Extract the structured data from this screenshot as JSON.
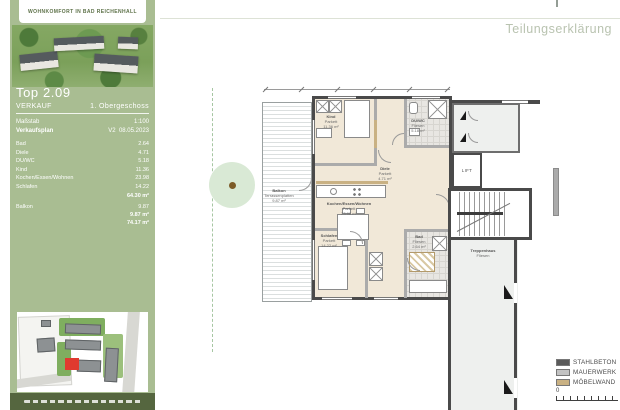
{
  "doc": {
    "label": "Teilungserklärung"
  },
  "sidebar": {
    "brand": {
      "tagline": "WOHNKOMFORT IN BAD REICHENHALL"
    },
    "unit": {
      "title": "Top 2.09",
      "status": "VERKAUF",
      "floor": "1. Obergeschoss",
      "scale_label": "Maßstab",
      "scale_value": "1:100",
      "plan_label": "Verkaufsplan",
      "plan_version": "V2",
      "plan_date": "08.05.2023"
    },
    "areas": {
      "rows": [
        {
          "label": "Bad",
          "value": "2.64"
        },
        {
          "label": "Diele",
          "value": "4.71"
        },
        {
          "label": "DU/WC",
          "value": "5.18"
        },
        {
          "label": "Kind",
          "value": "11.36"
        },
        {
          "label": "Kochen/Essen/Wohnen",
          "value": "23.98"
        },
        {
          "label": "Schlafen",
          "value": "14.22"
        }
      ],
      "subtotal": "64.30 m²",
      "balcony_row": {
        "label": "Balkon",
        "value": "9.87"
      },
      "balcony_subtotal": "9.87 m²",
      "total": "74.17 m²"
    }
  },
  "plan": {
    "rooms": [
      {
        "name": "Kind",
        "floor": "Parkett",
        "area": "11.36 m²"
      },
      {
        "name": "DU/WC",
        "floor": "Fliesen",
        "area": "5.18 m²"
      },
      {
        "name": "Diele",
        "floor": "Parkett",
        "area": "4.71 m²"
      },
      {
        "name": "Kochen/Essen/Wohnen",
        "floor": "Parkett",
        "area": "23.98 m²"
      },
      {
        "name": "Schlafen",
        "floor": "Parkett",
        "area": "14.22 m²"
      },
      {
        "name": "Bad",
        "floor": "Fliesen",
        "area": "2.64 m²"
      },
      {
        "name": "Balkon",
        "floor": "Terrassenplatten",
        "area": "9.87 m²"
      },
      {
        "name": "Treppenhaus",
        "floor": "Fliesen",
        "area": ""
      }
    ],
    "lift_label": "LIFT"
  },
  "legend": {
    "items": [
      {
        "label": "STAHLBETON",
        "color": "#5a5a5a"
      },
      {
        "label": "MAUERWERK",
        "color": "#c2c2c2"
      },
      {
        "label": "MÖBELWAND",
        "color": "#c9b183"
      }
    ],
    "scale_zero": "0"
  },
  "colors": {
    "sidebar_green": "#a9bd92",
    "footer_green": "#55663f",
    "heading_gray": "#b9c3b0",
    "highlight_red": "#e03a2f"
  }
}
